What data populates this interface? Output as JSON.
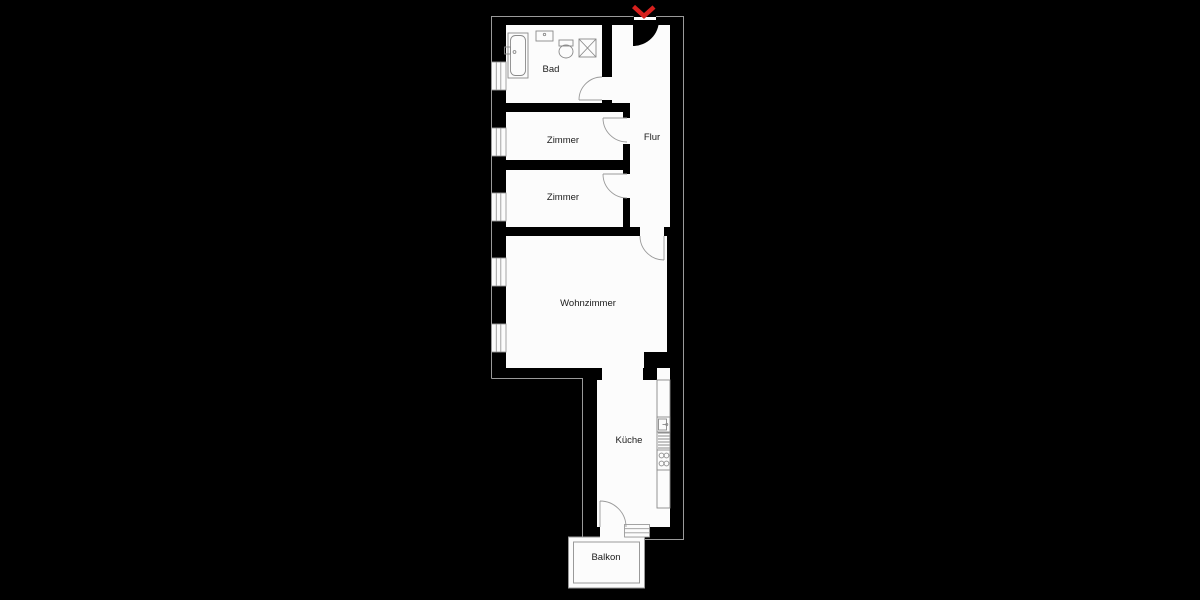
{
  "plan": {
    "type": "apartment-floor-plan",
    "rooms": [
      {
        "id": "bad",
        "label": "Bad"
      },
      {
        "id": "zimmer-1",
        "label": "Zimmer"
      },
      {
        "id": "zimmer-2",
        "label": "Zimmer"
      },
      {
        "id": "flur",
        "label": "Flur"
      },
      {
        "id": "wohnzimmer",
        "label": "Wohnzimmer"
      },
      {
        "id": "kueche",
        "label": "Küche"
      },
      {
        "id": "balkon",
        "label": "Balkon"
      }
    ],
    "entrance": {
      "marker": "red-chevron",
      "location": "top-right"
    },
    "fixtures": [
      "bathtub",
      "bathroom-sink",
      "toilet",
      "shower",
      "kitchen-counter",
      "kitchen-sink",
      "kitchen-grill",
      "stove",
      "balcony-steps",
      "window-x5"
    ],
    "window_count": 5,
    "colors": {
      "background": "#000000",
      "room_fill": "#fcfcfc",
      "outline": "#9a9a9a",
      "fixture_stroke": "#8a8a8a",
      "door_arc": "#9a9a9a",
      "entrance_arrow": "#d7201d",
      "label_text": "#1b1b1b"
    }
  }
}
